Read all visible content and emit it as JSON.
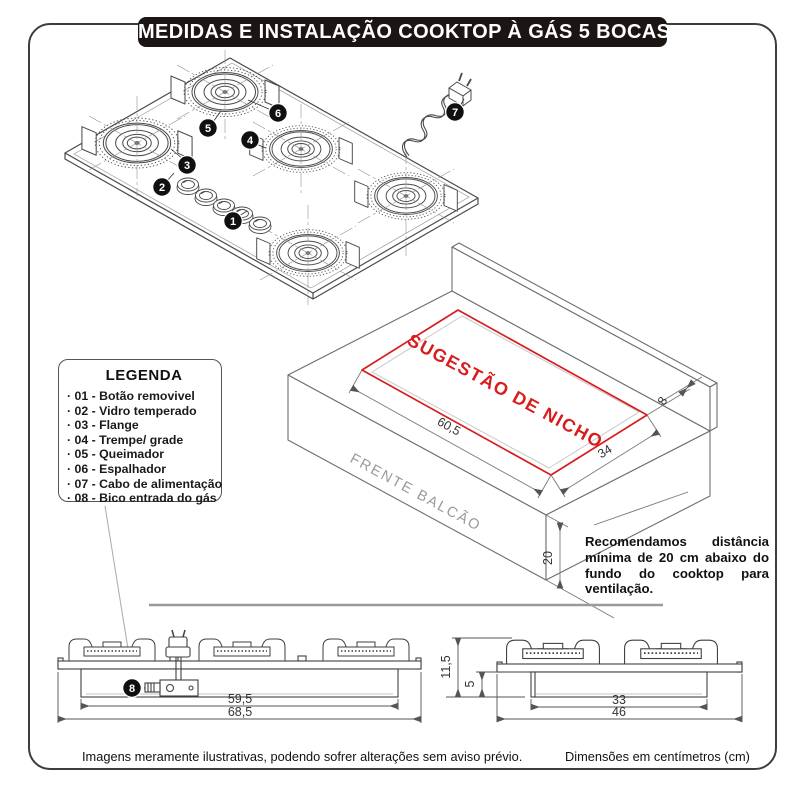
{
  "title": "MEDIDAS E INSTALAÇÃO COOKTOP À GÁS 5 BOCAS",
  "colors": {
    "accent_red": "#d91c1c",
    "title_bg": "#1b1613",
    "line_gray": "#6e6e6e"
  },
  "legend": {
    "title": "LEGENDA",
    "items": [
      "· 01 - Botão removivel",
      "· 02 - Vidro temperado",
      "· 03 - Flange",
      "· 04 - Trempe/ grade",
      "· 05 - Queimador",
      "· 06 - Espalhador",
      "· 07 - Cabo de alimentação",
      "· 08 - Bico entrada do gás"
    ]
  },
  "callouts": [
    "1",
    "2",
    "3",
    "4",
    "5",
    "6",
    "7",
    "8"
  ],
  "counter": {
    "niche_label": "SUGESTÃO DE NICHO",
    "front_label": "FRENTE BALCÃO",
    "niche_width": "60,5",
    "niche_depth": "34",
    "niche_back_offset": "8",
    "clearance_below": "20",
    "recommendation": "Recomendamos distância mínima de 20 cm abaixo do fundo do cooktop para ventilação."
  },
  "front_view": {
    "inner_width": "59,5",
    "outer_width": "68,5"
  },
  "side_view": {
    "total_height": "11,5",
    "body_height": "5",
    "inner_width": "33",
    "outer_width": "46"
  },
  "footer": {
    "left": "Imagens meramente ilustrativas, podendo sofrer alterações sem aviso prévio.",
    "right": "Dimensões em centímetros (cm)"
  }
}
